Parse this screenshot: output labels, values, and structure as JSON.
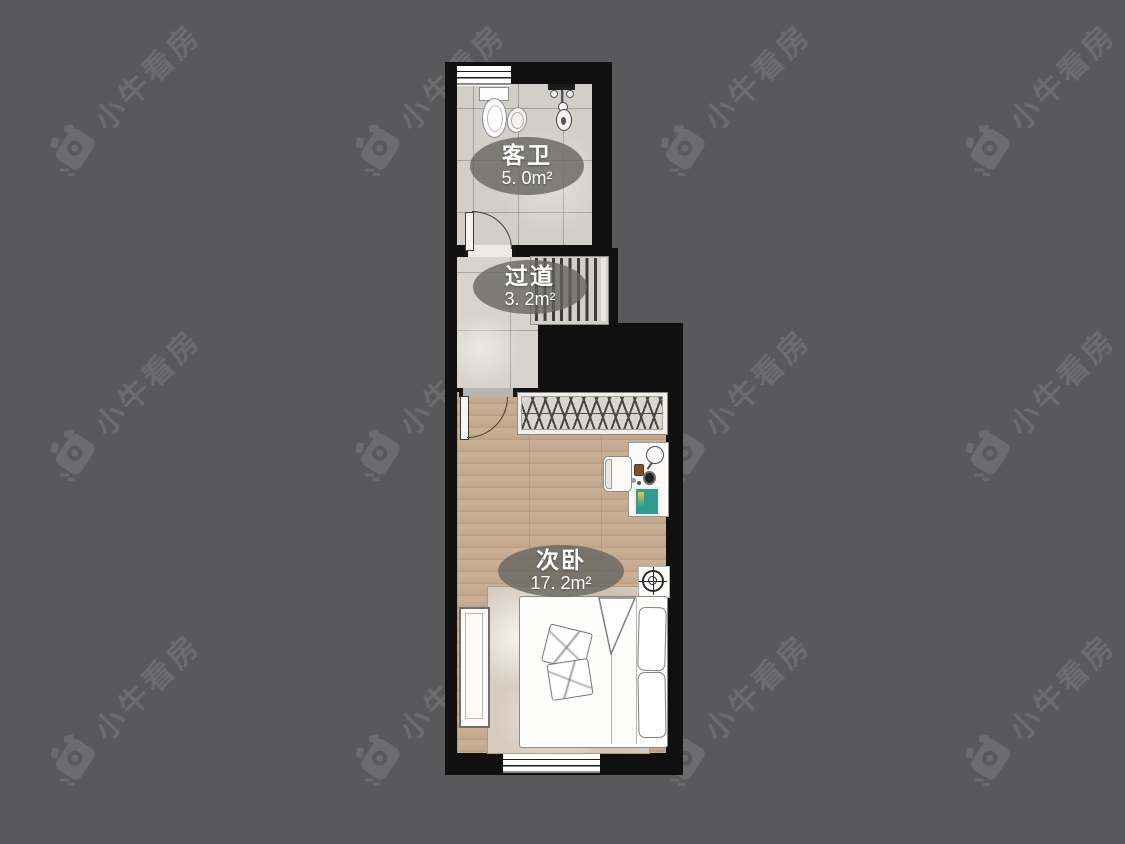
{
  "watermark": {
    "text": "小牛看房",
    "color": "#6c6c6e"
  },
  "canvas": {
    "background": "#59595b",
    "width": 1125,
    "height": 844
  },
  "floorplan": {
    "rooms": [
      {
        "id": "bathroom",
        "name": "客卫",
        "area": "5. 0m²"
      },
      {
        "id": "hallway",
        "name": "过道",
        "area": "3. 2m²"
      },
      {
        "id": "bedroom",
        "name": "次卧",
        "area": "17. 2m²"
      }
    ],
    "colors": {
      "wall": "#101010",
      "tile": "#d2cfc8",
      "wood": "#c5ac90",
      "label_bg": "rgba(100,99,95,0.78)"
    }
  }
}
